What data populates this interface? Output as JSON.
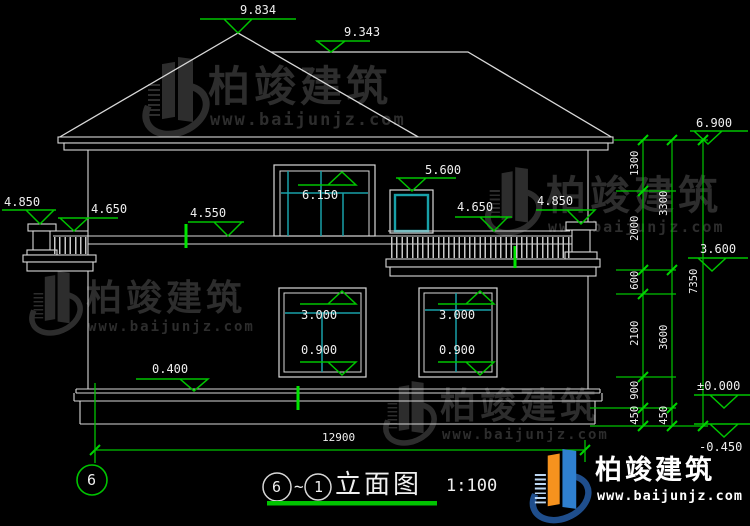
{
  "drawing": {
    "levels": {
      "roof_peak": "9.834",
      "roof_ridge": "9.343",
      "eaves": "6.900",
      "left_post_top": "4.850",
      "left_rail_top": "4.650",
      "floor_band": "4.550",
      "big_window_head": "6.150",
      "small_window_head": "5.600",
      "right_rail_top": "4.650",
      "right_post_top": "4.850",
      "second_floor": "3.600",
      "window_head": "3.000",
      "window_sill": "0.900",
      "plinth_top": "0.400",
      "ground_zero": "±0.000",
      "ground": "-0.450"
    },
    "dim_chains": {
      "inner": [
        "1300",
        "2000",
        "600",
        "2100",
        "900",
        "450"
      ],
      "middle": [
        "3300",
        "3600",
        "450"
      ],
      "outer": [
        "7350"
      ],
      "overall_width": "12900"
    },
    "axis": {
      "left_bubble": "6"
    },
    "title": {
      "start_bubble": "6",
      "tilde": "~",
      "end_bubble": "1",
      "name": "立面图",
      "scale": "1:100"
    }
  },
  "watermark": {
    "brand": "柏竣建筑",
    "url": "www.baijunjz.com"
  },
  "logo": {
    "brand": "柏竣建筑",
    "url": "www.baijunjz.com"
  },
  "colors": {
    "background": "#000000",
    "line_white": "#d8d8d8",
    "dimension_green": "#00c400",
    "mullion_teal": "#18a0a8",
    "logo_blue": "#2f80d0",
    "logo_orange": "#f6921e"
  }
}
